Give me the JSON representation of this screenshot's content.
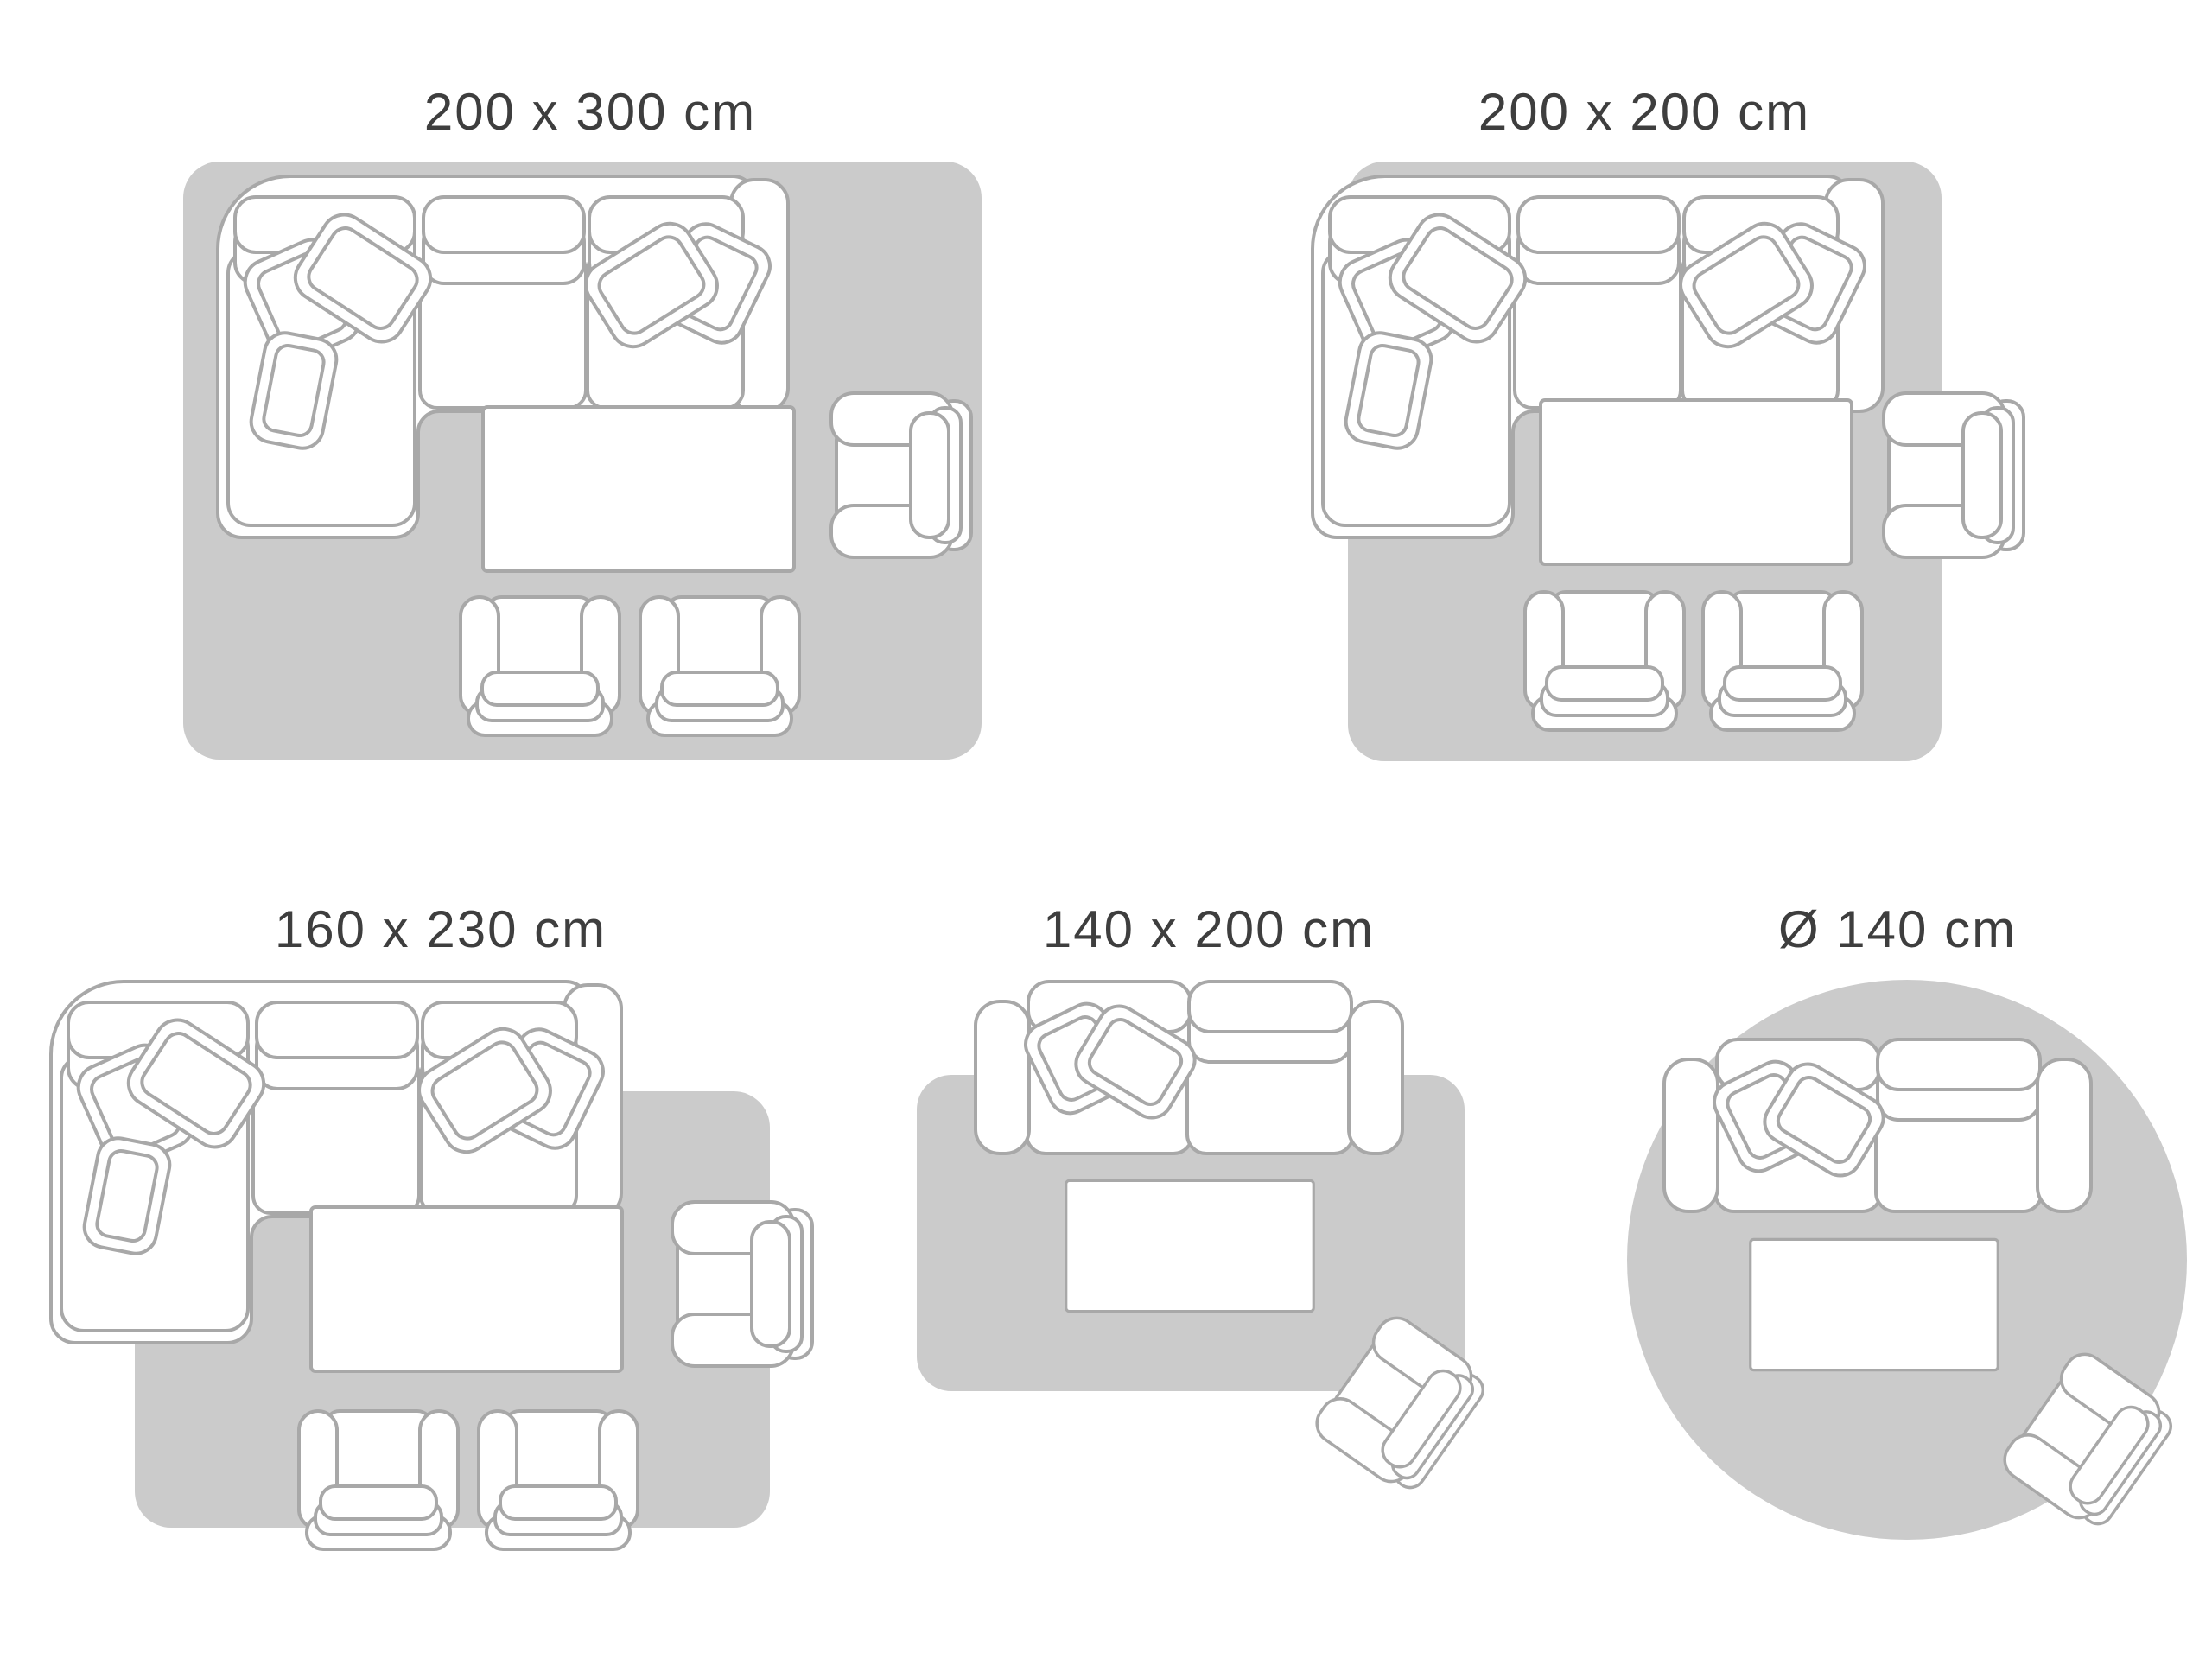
{
  "colors": {
    "background": "#ffffff",
    "rug": "#cbcbcb",
    "outline": "#a8a8a8",
    "furniture_fill": "#ffffff",
    "label": "#3e3e3e"
  },
  "diagrams": [
    {
      "label": "200 x 300 cm",
      "shape": "rectangular rug",
      "depicts": [
        "corner sofa with cushions",
        "coffee table",
        "armchair",
        "two footstools"
      ]
    },
    {
      "label": "200 x 200 cm",
      "shape": "rectangular rug",
      "depicts": [
        "corner sofa with cushions",
        "coffee table",
        "armchair",
        "two footstools"
      ]
    },
    {
      "label": "160 x 230 cm",
      "shape": "rectangular rug",
      "depicts": [
        "corner sofa with cushions",
        "coffee table",
        "armchair",
        "two footstools"
      ]
    },
    {
      "label": "140 x 200 cm",
      "shape": "rectangular rug",
      "depicts": [
        "two-seat sofa with cushions",
        "coffee table",
        "angled armchair"
      ]
    },
    {
      "label": "Ø 140 cm",
      "shape": "round rug",
      "depicts": [
        "two-seat sofa with cushions",
        "coffee table",
        "angled armchair"
      ]
    }
  ]
}
